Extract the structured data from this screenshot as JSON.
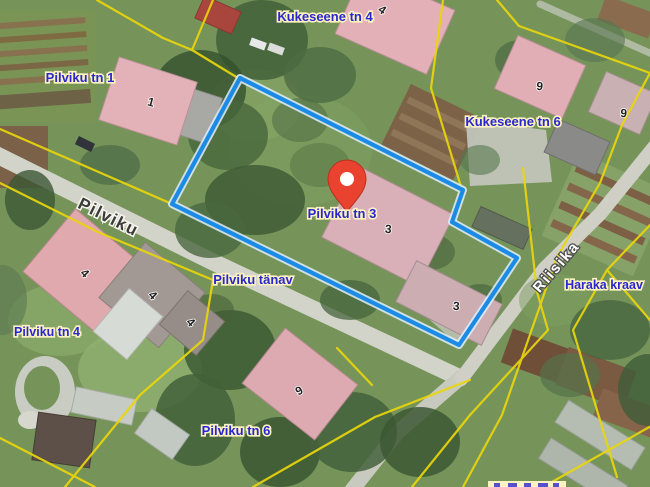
{
  "map": {
    "address_labels": [
      {
        "id": "kukeseene-tn-4",
        "text": "Kukeseene tn 4"
      },
      {
        "id": "pilviku-tn-1",
        "text": "Pilviku tn 1"
      },
      {
        "id": "kukeseene-tn-6",
        "text": "Kukeseene tn 6"
      },
      {
        "id": "pilviku-tn-3",
        "text": "Pilviku tn 3"
      },
      {
        "id": "pilviku-tanav",
        "text": "Pilviku tänav"
      },
      {
        "id": "pilviku-tn-4",
        "text": "Pilviku tn 4"
      },
      {
        "id": "pilviku-tn-6",
        "text": "Pilviku tn 6"
      },
      {
        "id": "haraka-kraav",
        "text": "Haraka kraav"
      }
    ],
    "street_labels": [
      {
        "id": "pilviku-street",
        "text": "Pilviku"
      },
      {
        "id": "riisika-street",
        "text": "Riisika"
      }
    ],
    "building_numbers": [
      "4",
      "1",
      "6",
      "6",
      "3",
      "3",
      "4",
      "4",
      "4",
      "6"
    ],
    "colors": {
      "label_blue": "#2a28cd",
      "label_halo_cream": "#fbf2c0",
      "cadastral_yellow": "#e9d60b",
      "selection_blue": "#1b8be6",
      "marker_red": "#e9432f",
      "street_name_dark": "#3b3b3b",
      "street_name_light": "#ffffff"
    }
  }
}
